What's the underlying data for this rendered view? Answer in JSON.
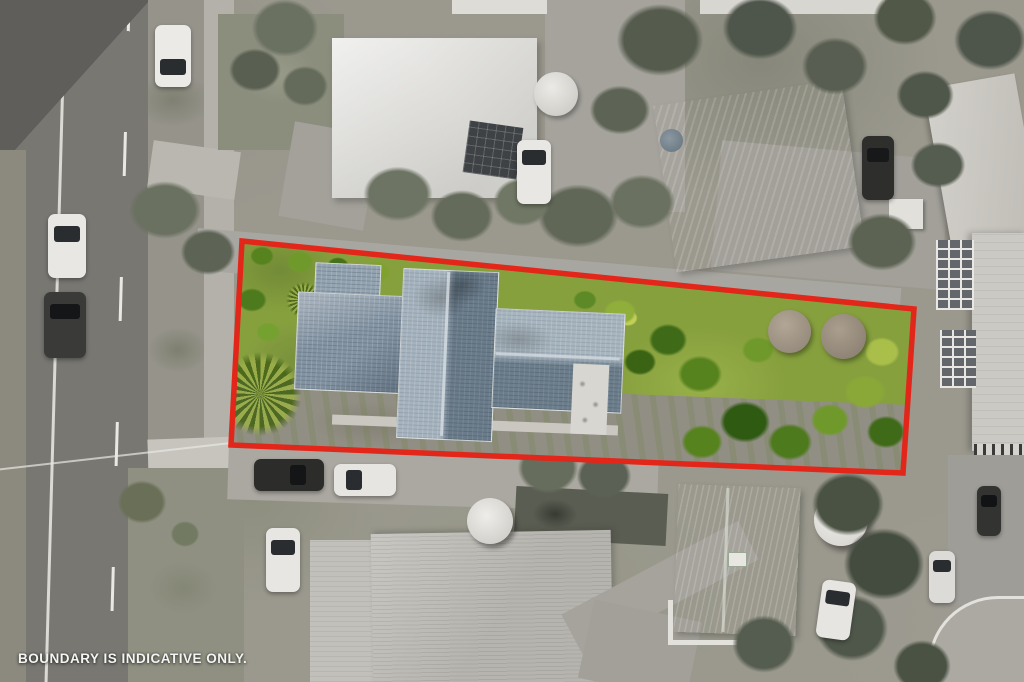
{
  "overlay": {
    "disclaimer": "BOUNDARY IS INDICATIVE ONLY.",
    "boundary_color": "#e2261a",
    "boundary_points": "242,241 914,309 903,473 231,445"
  },
  "palette": {
    "road_asphalt": "#787772",
    "surroundings_ground": "#9b998e",
    "subject_lawn": "#87a03e",
    "subject_roof": "#8799a8",
    "green_roof_house": "#87a286",
    "road_marking": "#e9e8e2",
    "caption_text": "#f4f4f2"
  }
}
